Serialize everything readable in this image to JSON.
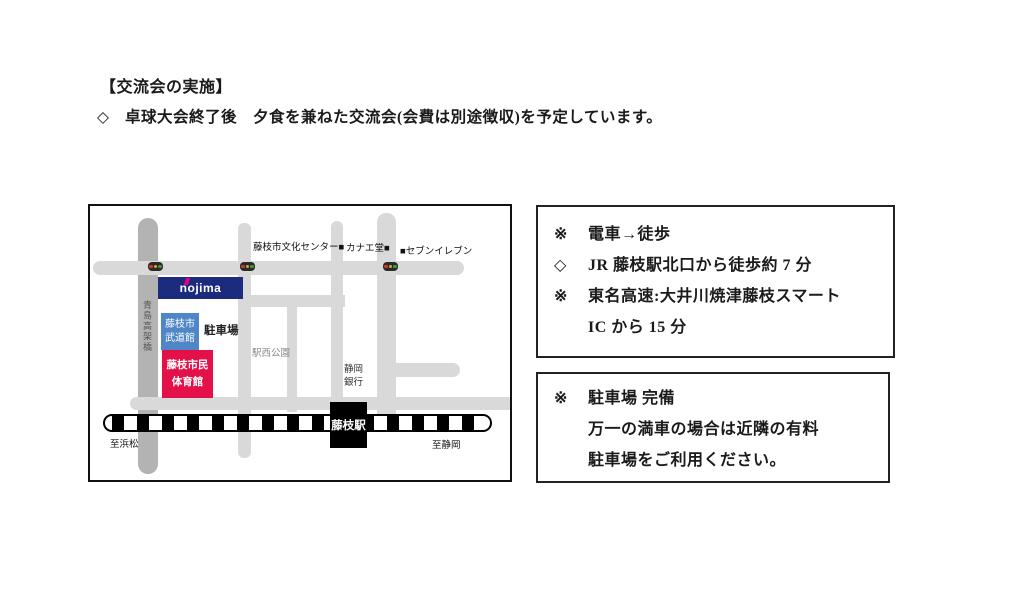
{
  "page": {
    "heading": "【交流会の実施】",
    "bullet_marker": "◇",
    "bullet_text": "卓球大会終了後　夕食を兼ねた交流会(会費は別途徴収)を予定しています。"
  },
  "access_box": {
    "lines": [
      {
        "marker": "※",
        "text": "電車→徒歩"
      },
      {
        "marker": "◇",
        "text": "JR 藤枝駅北口から徒歩約 7 分"
      },
      {
        "marker": "※",
        "text": "東名高速:大井川焼津藤枝スマート"
      },
      {
        "marker": "",
        "text": "IC から 15 分"
      }
    ]
  },
  "parking_box": {
    "lines": [
      {
        "marker": "※",
        "text": "駐車場 完備"
      },
      {
        "marker": "",
        "text": "万一の満車の場合は近隣の有料"
      },
      {
        "marker": "",
        "text": "駐車場をご利用ください。"
      }
    ]
  },
  "map": {
    "landmarks": {
      "culture_center": "藤枝市文化センター■",
      "kanae_do": "カナエ堂■",
      "seven_eleven": "■セブンイレブン",
      "nojima": "nojima",
      "budokan": [
        "藤枝市",
        "武道館"
      ],
      "parking": "駐車場",
      "station_west_park": "駅西公園",
      "shizuoka_bank": [
        "静岡",
        "銀行"
      ],
      "gym": [
        "藤枝市民",
        "体育館"
      ],
      "station": "藤枝駅",
      "bridge": "青島高架橋",
      "to_hamamatsu": "至浜松",
      "to_shizuoka": "至静岡"
    },
    "colors": {
      "road": "#d9d9d9",
      "bridge_road": "#b3b3b3",
      "nojima_bg": "#1c2b7d",
      "nojima_accent": "#e5007f",
      "budokan_bg": "#4f86c6",
      "gym_bg": "#e3104a",
      "station_bg": "#000000"
    }
  }
}
